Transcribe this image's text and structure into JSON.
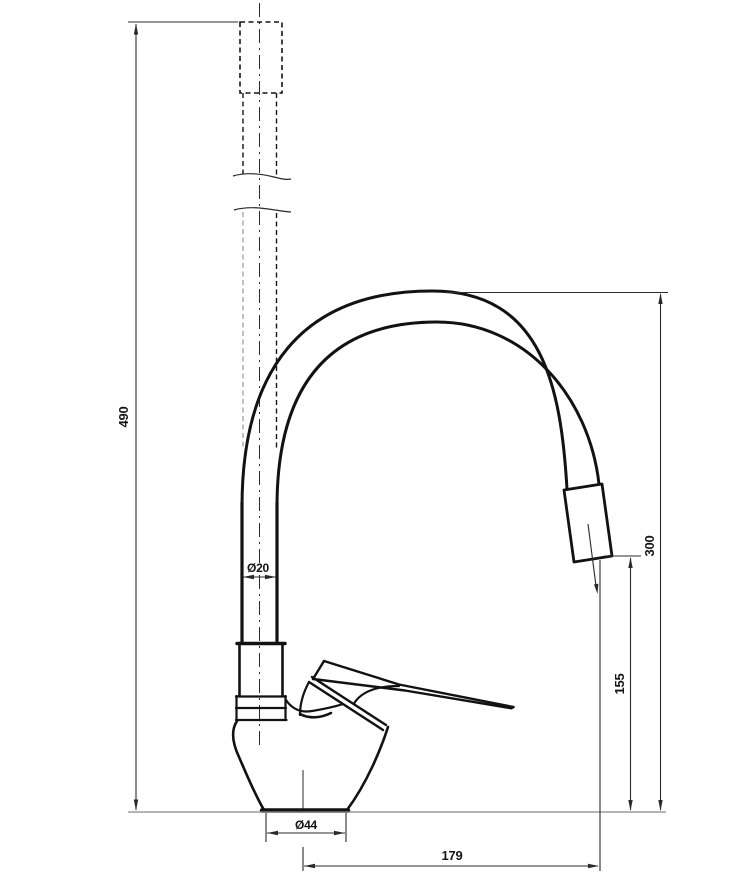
{
  "drawing": {
    "labels": {
      "overall_height": "490",
      "spout_top_height": "300",
      "outlet_height": "155",
      "reach": "179",
      "pipe_diameter": "Ø20",
      "base_diameter": "Ø44"
    },
    "colors": {
      "line": "#141414",
      "thin_line": "#2a2a2a",
      "baseline": "#888888",
      "ghost_gray": "#a8a8a8",
      "background": "#ffffff"
    }
  }
}
